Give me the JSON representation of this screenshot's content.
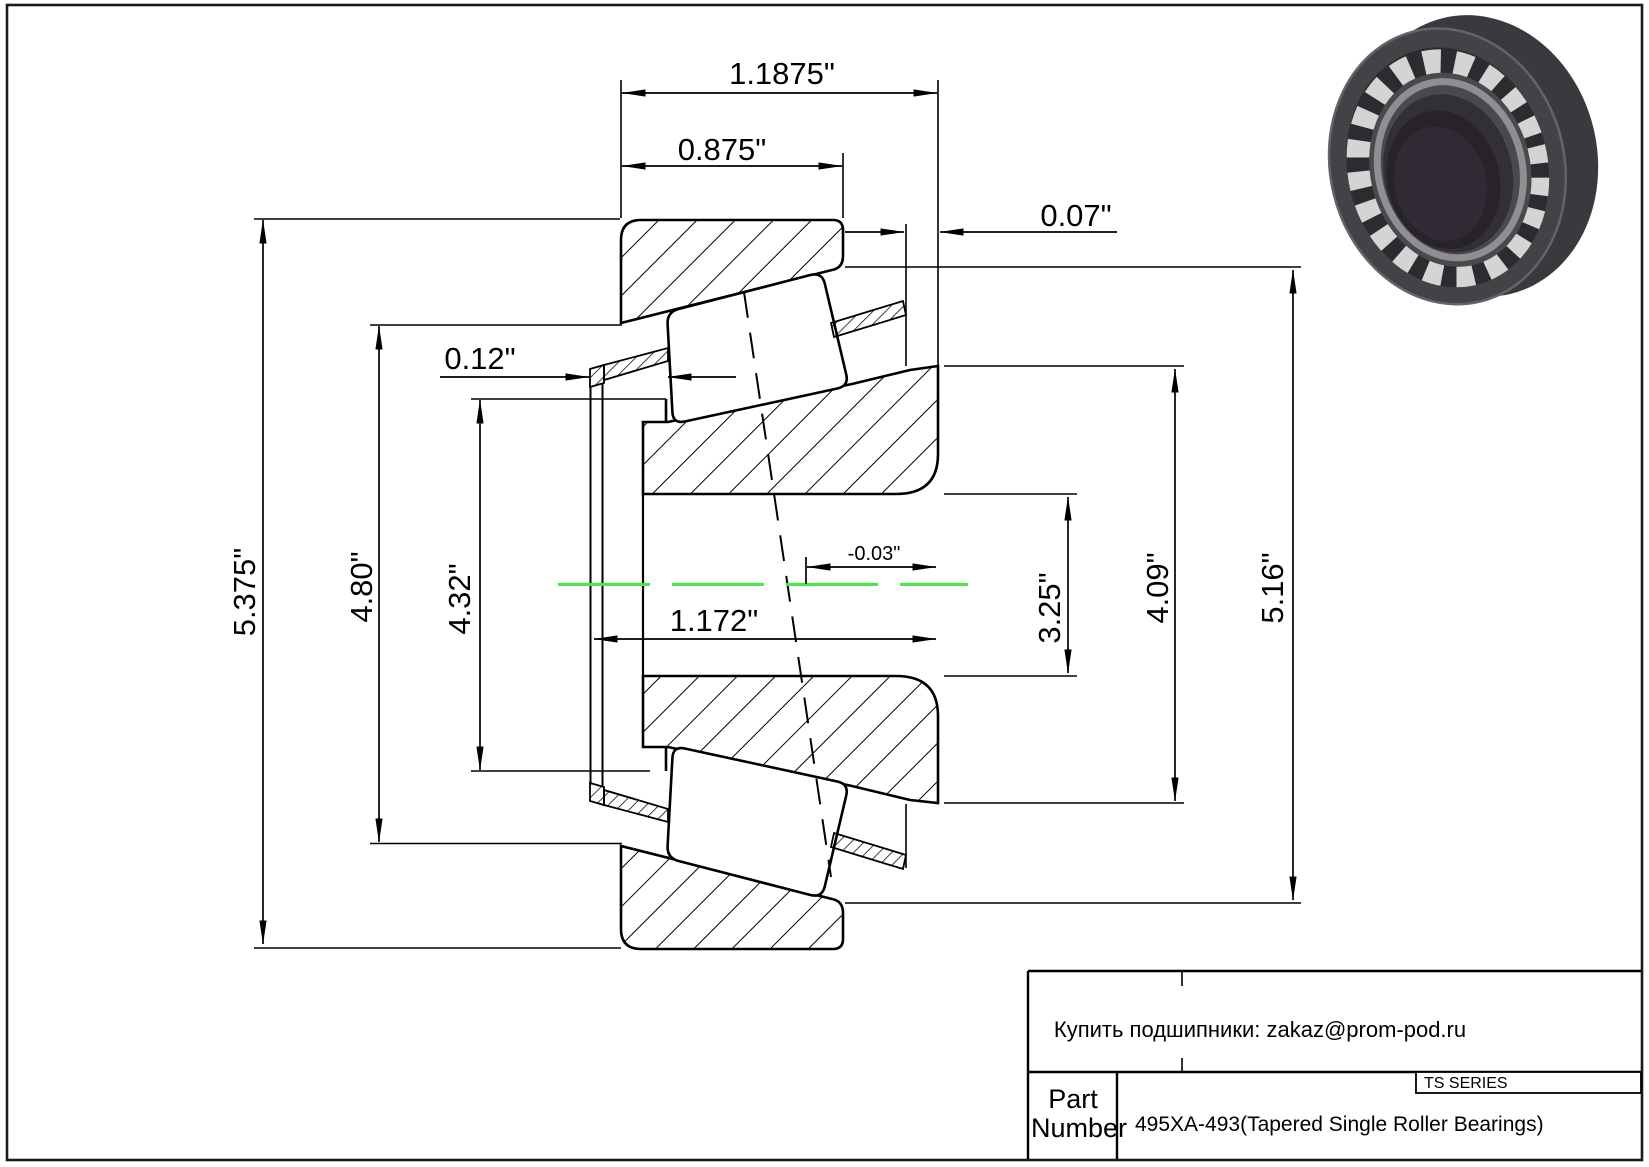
{
  "drawing": {
    "dim_labels": {
      "overall_width": "1.1875\"",
      "cup_width": "0.875\"",
      "cup_front_standout": "0.07\"",
      "cone_front_standout": "0.12\"",
      "cone_width": "1.172\"",
      "effective_center_offset": "-0.03\"",
      "outer_diameter": "5.375\"",
      "left_shoulder_outer": "4.80\"",
      "left_shoulder_inner": "4.32\"",
      "bore_diameter": "3.25\"",
      "cone_back_shoulder": "4.09\"",
      "cup_back_shoulder": "5.16\""
    }
  },
  "title_block": {
    "contact_line": "Купить подшипники: zakaz@prom-pod.ru",
    "part_label_line1": "Part",
    "part_label_line2": "Number",
    "series_label": "TS SERIES",
    "part_number": "495XA-493(Tapered Single Roller Bearings)"
  },
  "colors": {
    "line": "#000000",
    "centerline": "#44e944",
    "photo_body": "#3a393d"
  }
}
